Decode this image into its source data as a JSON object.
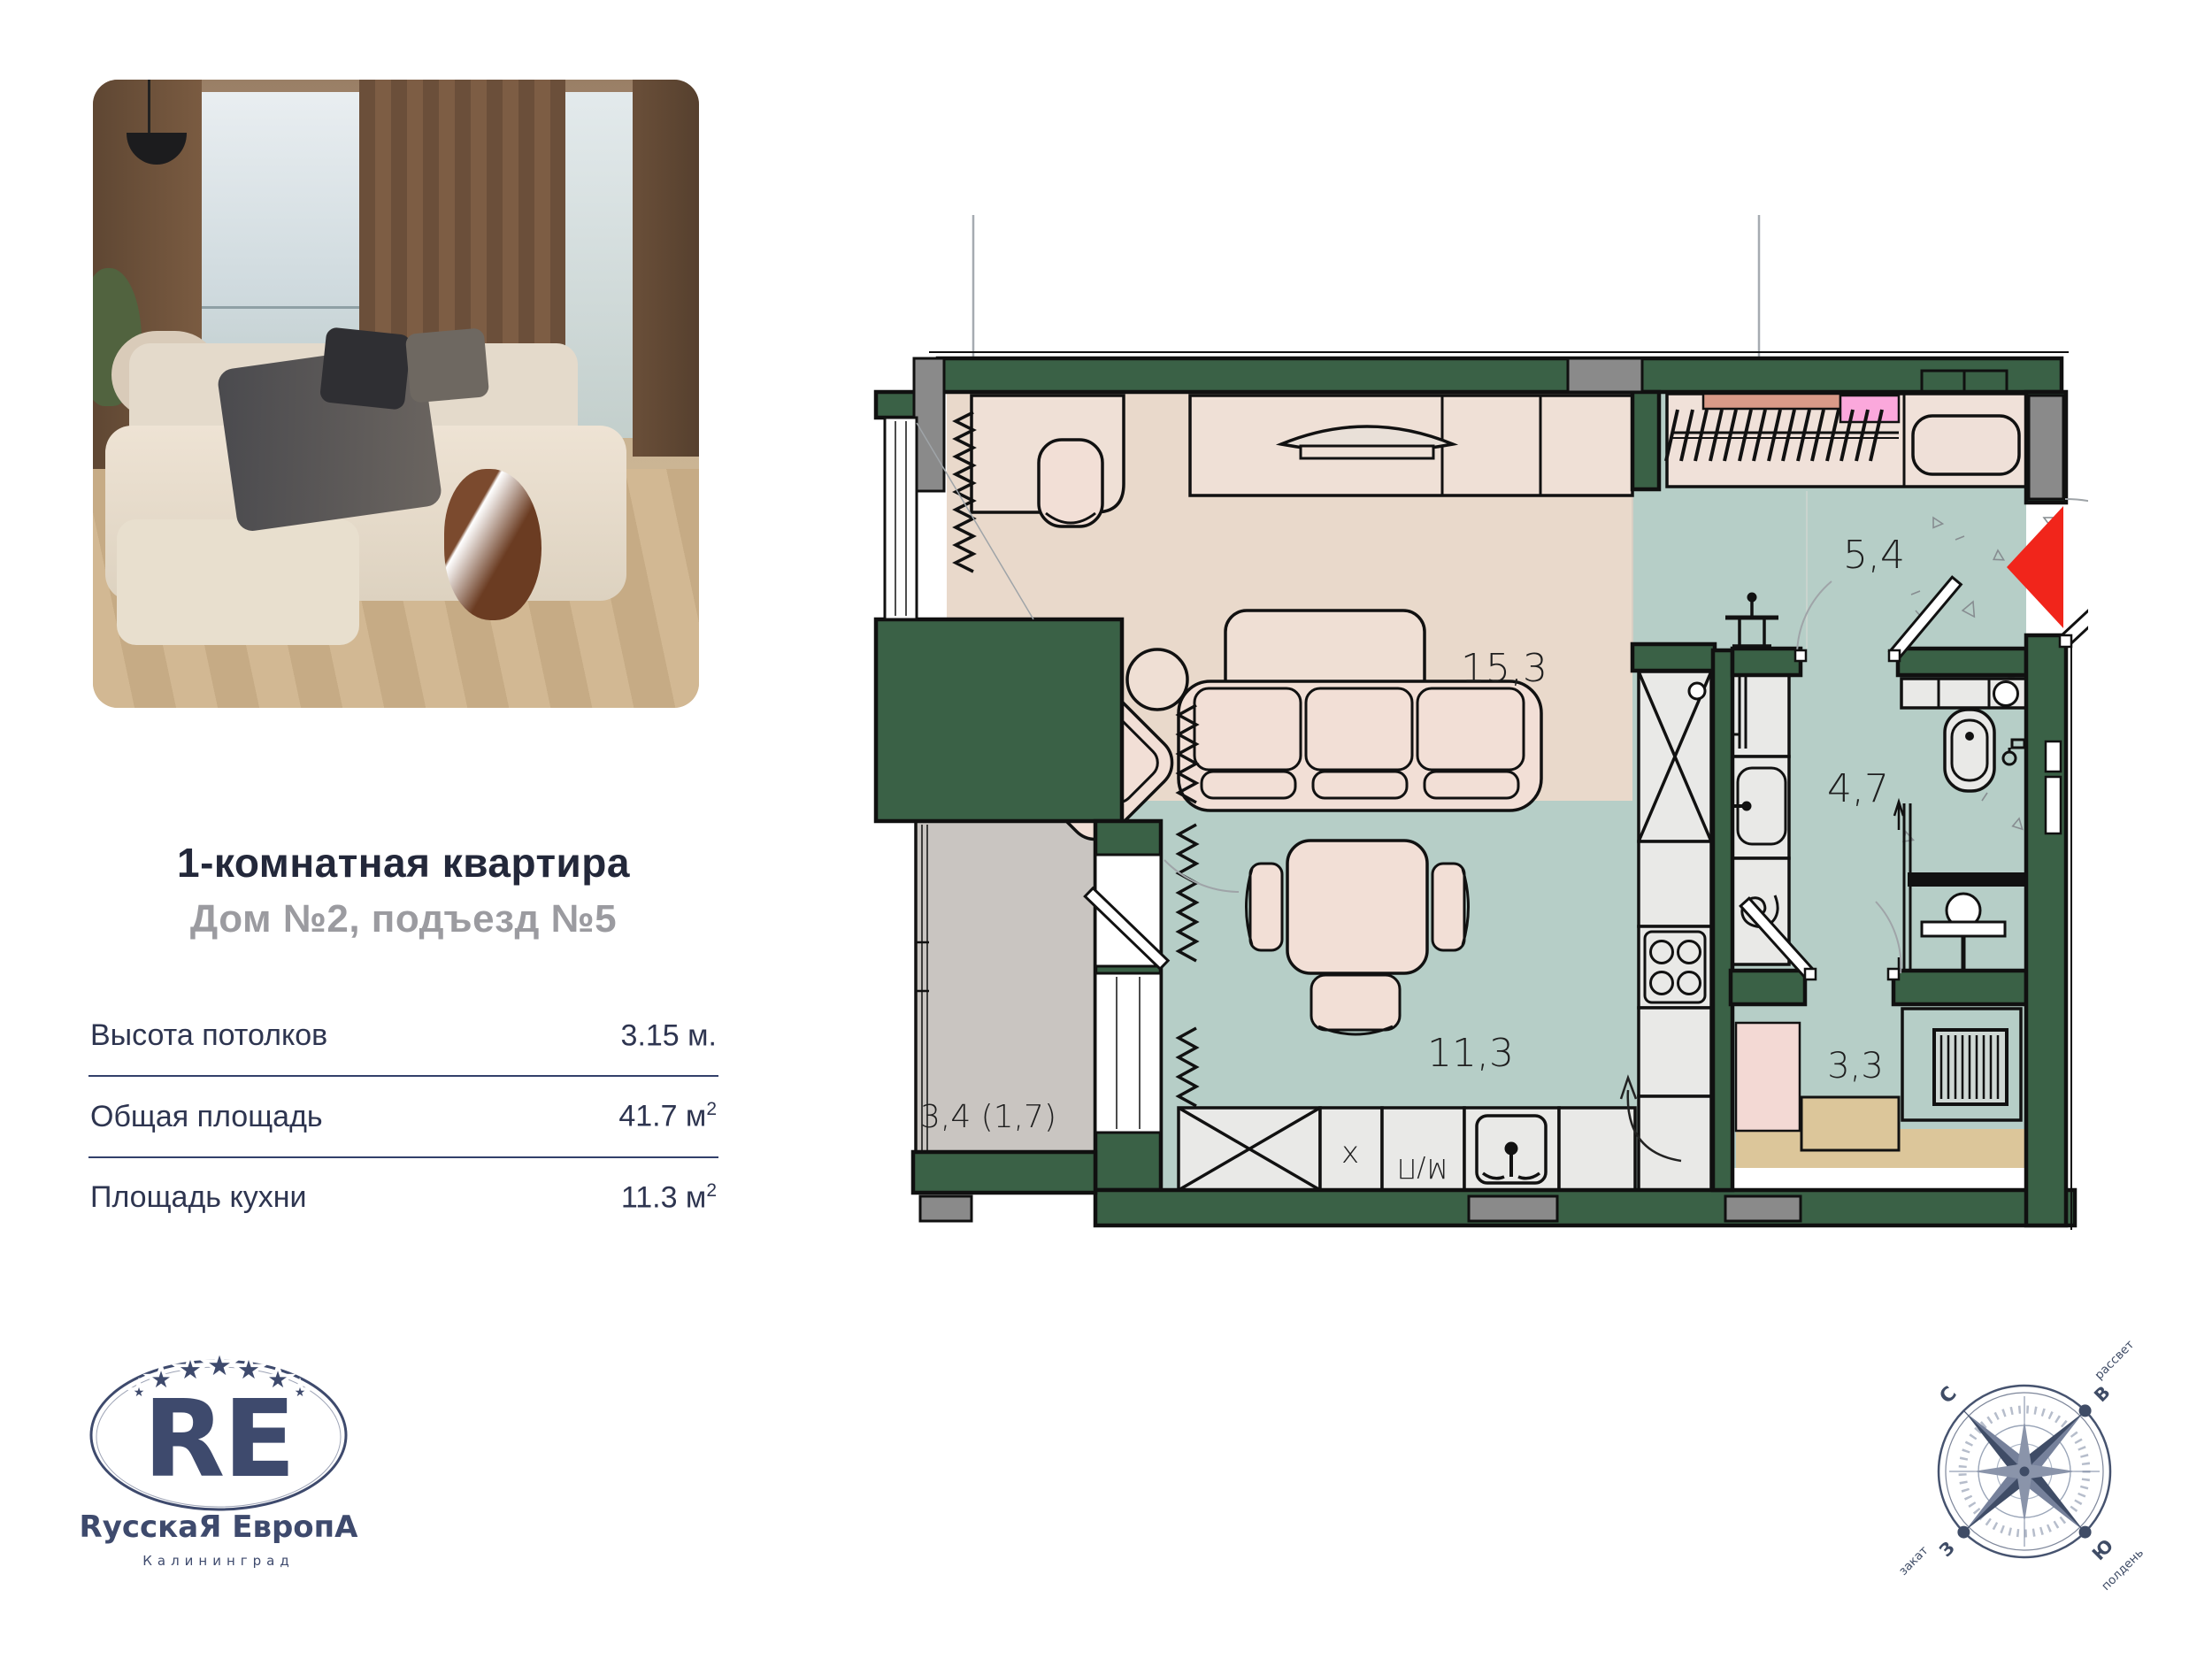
{
  "card": {
    "title": "1-комнатная квартира",
    "subtitle": "Дом №2, подъезд №5",
    "specs": [
      {
        "label": "Высота потолков",
        "value": "3.15 м.",
        "sup": ""
      },
      {
        "label": "Общая площадь",
        "value": "41.7 м",
        "sup": "2"
      },
      {
        "label": "Площадь кухни",
        "value": "11.3 м",
        "sup": "2"
      }
    ]
  },
  "plan": {
    "rooms": {
      "living": "15,3",
      "hall": "5,4",
      "bath": "4,7",
      "kitchen": "11,3",
      "storage": "3,3",
      "balcony": "3,4 (1,7)"
    },
    "kitchen_labels": {
      "hob": "x",
      "appliance": "М/П"
    }
  },
  "logo": {
    "monogram": "RE",
    "brand": "RусскаЯ ЕвропА",
    "city": "Калининград",
    "star_glyph": "★",
    "stars": 5
  },
  "compass": {
    "north": "С",
    "east": "В",
    "west": "З",
    "south": "Ю",
    "dawn": "рассвет",
    "sunset": "закат",
    "noon": "полдень"
  },
  "colors": {
    "wall_green": "#3a6146",
    "floor_living": "#e9d9cb",
    "floor_wet": "#b6cec7",
    "floor_balcony": "#c9c5c1",
    "floor_storage": "#dcc69a",
    "accent_red": "#f1251b",
    "accent_pink": "#fba8dc",
    "accent_salmon": "#d99a88",
    "navy": "#3e4a6d",
    "text_dark": "#23283a",
    "text_gray": "#9b9ba0"
  }
}
